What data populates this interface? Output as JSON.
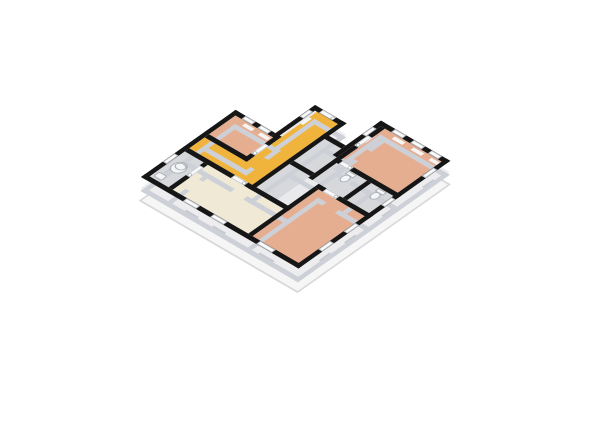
{
  "scene": {
    "kind": "isometric-3d-floor-plan",
    "background": "#ffffff"
  },
  "colors": {
    "background": "#ffffff",
    "wall_top": "#161616",
    "wall_face": "#cdd1d7",
    "floor_base": "#e9eaec",
    "bedroom_floor": "#e6ae90",
    "hall_floor": "#f0b43c",
    "living_floor": "#efe9d6",
    "utility_floor": "#d6d8dc",
    "base_slab": "#f6f6f7",
    "base_edge": "#d9d9db",
    "facade_band": "#ededef",
    "facade_recess": "#c6c9ce",
    "window_fill": "#fbfbfb",
    "window_frame": "#b9bdc2",
    "glass_hint": "#f4f5f6",
    "door_fill": "#fafafa",
    "door_edge": "#c9ccd1",
    "knob_fill": "#ffffff",
    "knob_edge": "#9aa0a6",
    "fixture_fill": "#f4f5f6",
    "fixture_stroke": "#aab0b6"
  },
  "rooms": [
    {
      "name": "bedroom-top-left",
      "floor": "#e6ae90"
    },
    {
      "name": "bedroom-right",
      "floor": "#e6ae90"
    },
    {
      "name": "bedroom-center-south",
      "floor": "#e6ae90"
    },
    {
      "name": "entrance-hall-corridor",
      "floor": "#f0b43c"
    },
    {
      "name": "living-room",
      "floor": "#efe9d6"
    },
    {
      "name": "bathroom-boiler",
      "floor": "#d6d8dc"
    },
    {
      "name": "utility-center-a",
      "floor": "#d6d8dc"
    },
    {
      "name": "utility-center-b",
      "floor": "#d6d8dc"
    },
    {
      "name": "wc-left",
      "floor": "#d6d8dc"
    },
    {
      "name": "wc-right",
      "floor": "#d6d8dc"
    }
  ]
}
